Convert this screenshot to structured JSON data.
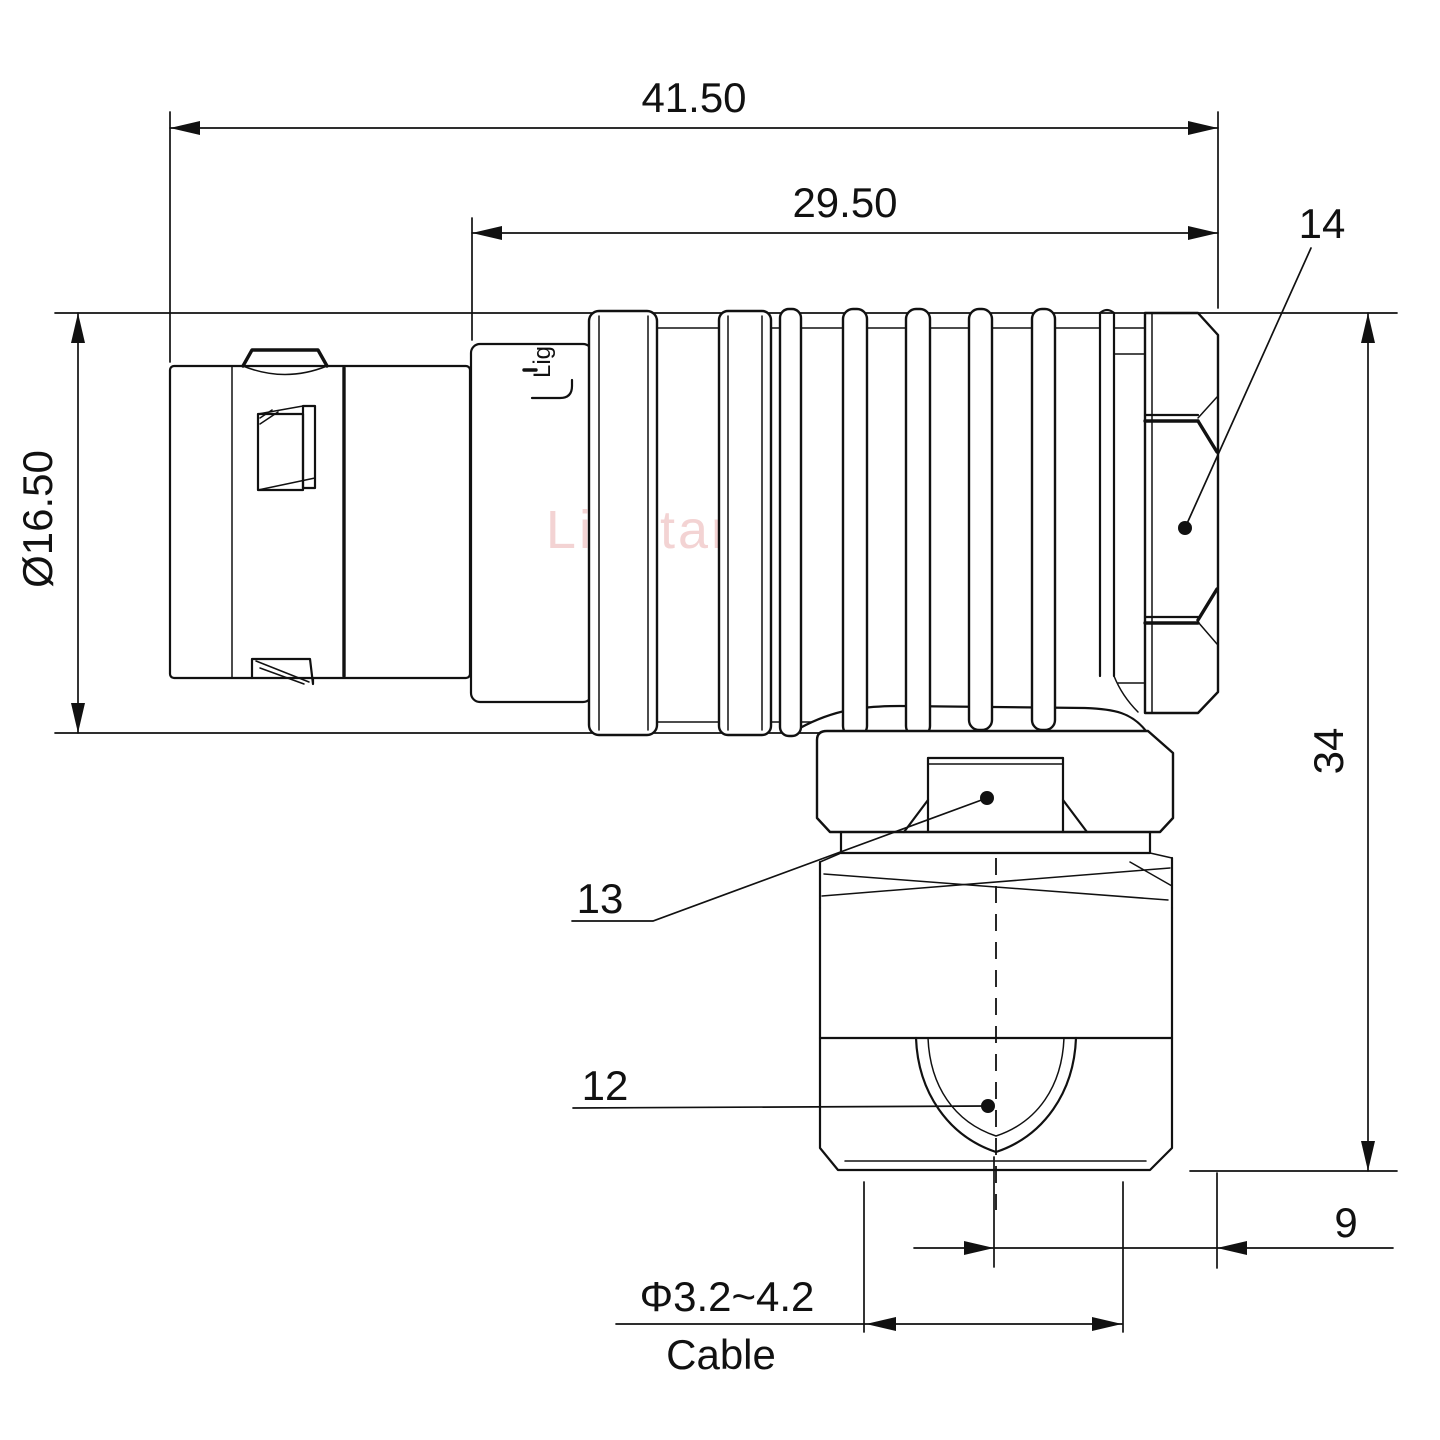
{
  "watermark": {
    "text": "Lightany",
    "color": "#efc5c5"
  },
  "engraving": {
    "text": "Lig"
  },
  "dimensions": {
    "overall_length": "41.50",
    "rear_length": "29.50",
    "front_diameter": "Ø16.50",
    "height": "34",
    "side_offset": "9",
    "cable_diameter": "Φ3.2~4.2",
    "cable_word": "Cable"
  },
  "callouts": {
    "coupling_nut": "14",
    "back_nut": "13",
    "cable_bushing": "12"
  },
  "colors": {
    "line": "#111111",
    "background": "#ffffff"
  }
}
